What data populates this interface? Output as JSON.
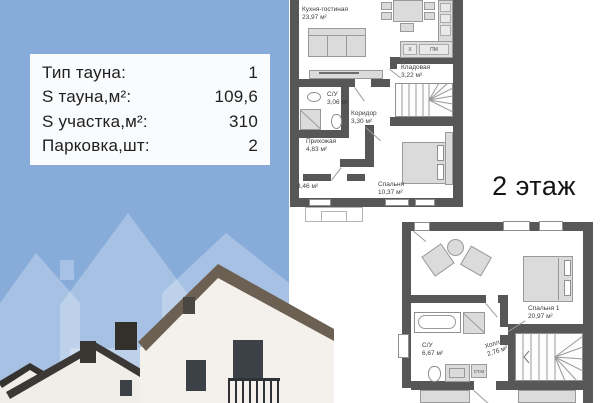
{
  "info_card": {
    "rows": [
      {
        "label": "Тип тауна:",
        "value": "1"
      },
      {
        "label": "S тауна,м²:",
        "value": "109,6"
      },
      {
        "label": "S участка,м²:",
        "value": "310"
      },
      {
        "label": "Парковка,шт:",
        "value": "2"
      }
    ]
  },
  "floor_label": "2 этаж",
  "plan1": {
    "rooms": {
      "kitchen": {
        "name": "Кухня-гостиная",
        "area": "23,97 м²"
      },
      "storage": {
        "name": "Кладовая",
        "area": "3,22 м²"
      },
      "bath": {
        "name": "С/У",
        "area": "3,06 м²"
      },
      "corridor": {
        "name": "Коридор",
        "area": "3,30 м²"
      },
      "hallway": {
        "name": "Прихожая",
        "area": "4,83 м²"
      },
      "vestibule": {
        "area": "3,46 м²"
      },
      "bedroom": {
        "name": "Спальня",
        "area": "10,37 м²"
      }
    },
    "kitchen_labels": {
      "sink": "X",
      "dishwasher": "ПМ"
    }
  },
  "plan2": {
    "rooms": {
      "bedroom1": {
        "name": "Спальня 1",
        "area": "20,97 м²"
      },
      "bath": {
        "name": "С/У",
        "area": "6,67 м²"
      },
      "hall": {
        "name": "Холл",
        "area": "2,76 м²"
      }
    },
    "washer_label": "СТ.М"
  },
  "colors": {
    "background_blue": "#87ACDA",
    "plan_wall": "#575757",
    "card_bg": "#FFFFFF"
  }
}
